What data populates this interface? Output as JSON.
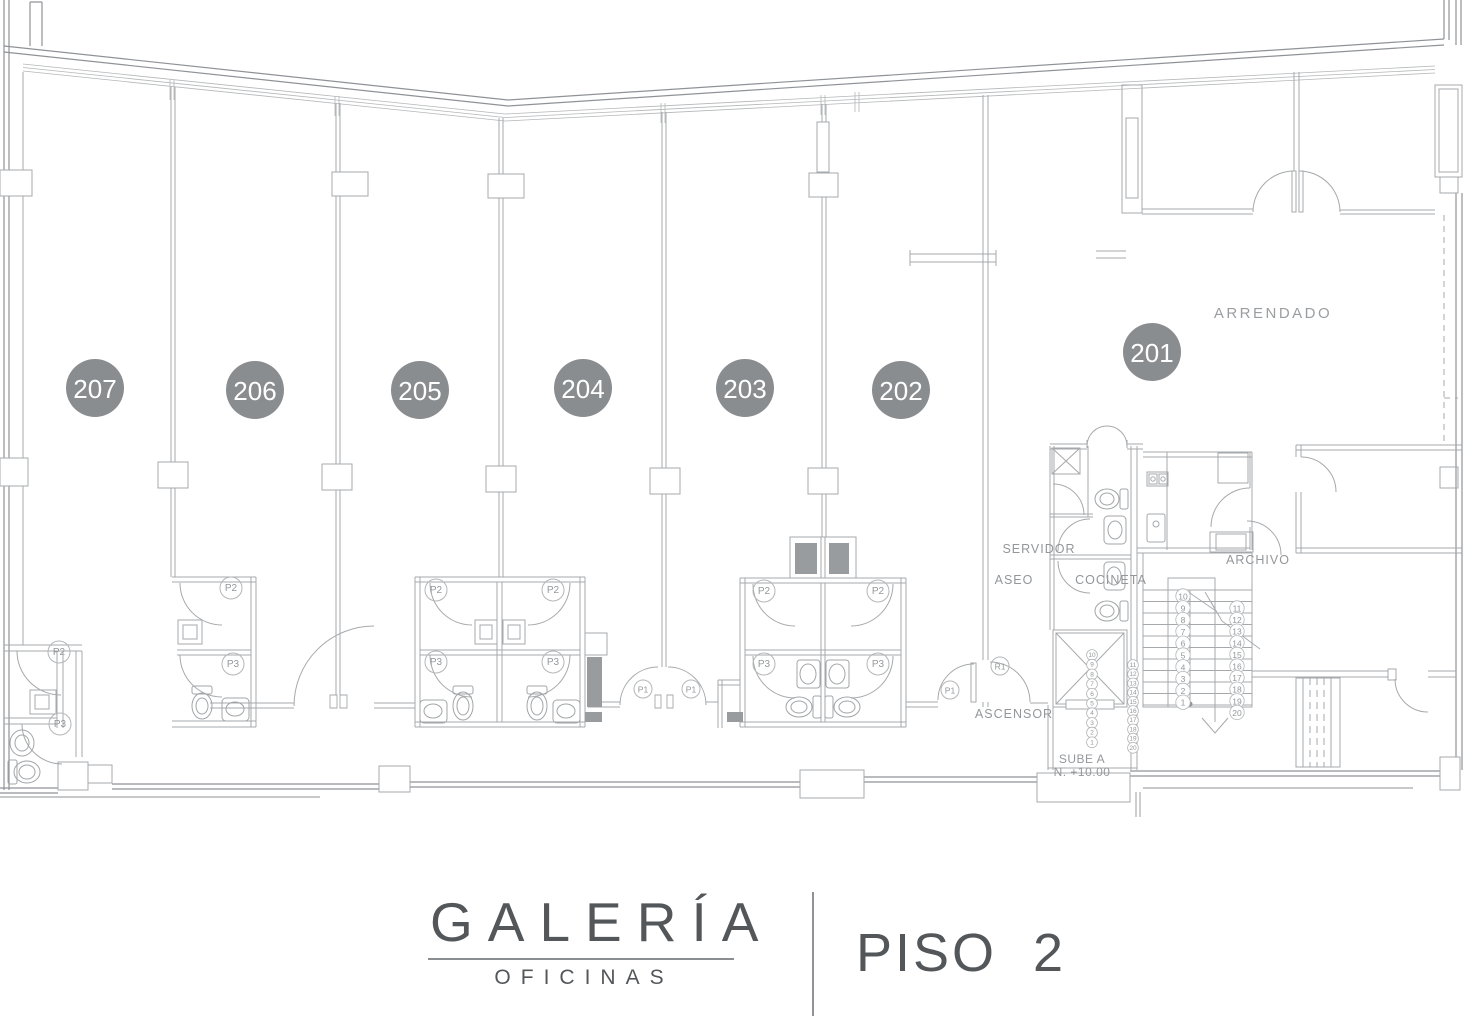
{
  "title_block": {
    "brand": "GALERÍA",
    "brand_sub": "OFICINAS",
    "floor": "PISO  2"
  },
  "units": [
    {
      "number": "207"
    },
    {
      "number": "206"
    },
    {
      "number": "205"
    },
    {
      "number": "204"
    },
    {
      "number": "203"
    },
    {
      "number": "202"
    },
    {
      "number": "201"
    }
  ],
  "labels": {
    "arrendado": "ARRENDADO",
    "servidor": "SERVIDOR",
    "aseo": "ASEO",
    "cocineta": "COCINETA",
    "archivo": "ARCHIVO",
    "ascensor": "ASCENSOR",
    "sube_a": "SUBE A",
    "nivel": "N. +10.00"
  },
  "door_tags": [
    "P2",
    "P2",
    "P2",
    "P2",
    "P2",
    "P2",
    "P3",
    "P3",
    "P3",
    "P3",
    "P3",
    "P3",
    "P1",
    "P1",
    "P1",
    "R1"
  ],
  "stair_treads": {
    "big_left": [
      "10",
      "9",
      "8",
      "7",
      "6",
      "5",
      "4",
      "3",
      "2",
      "1"
    ],
    "big_right": [
      "11",
      "12",
      "13",
      "14",
      "15",
      "16",
      "17",
      "18",
      "19",
      "20"
    ],
    "small_left": [
      "10",
      "9",
      "8",
      "7",
      "6",
      "5",
      "4",
      "3",
      "2",
      "1"
    ],
    "small_right": [
      "11",
      "12",
      "13",
      "14",
      "15",
      "16",
      "17",
      "18",
      "19",
      "20"
    ]
  },
  "colors": {
    "unit_circle_fill": "#8a8d90",
    "unit_circle_text": "#ffffff",
    "wall_strong": "#8f9296",
    "wall": "#a6a9ab",
    "fine_line": "#b4b6b8",
    "fixture": "#a2a5a7",
    "gray_fill": "#999c9f",
    "annotation_text": "#94979a",
    "brand_text": "#54575a"
  }
}
